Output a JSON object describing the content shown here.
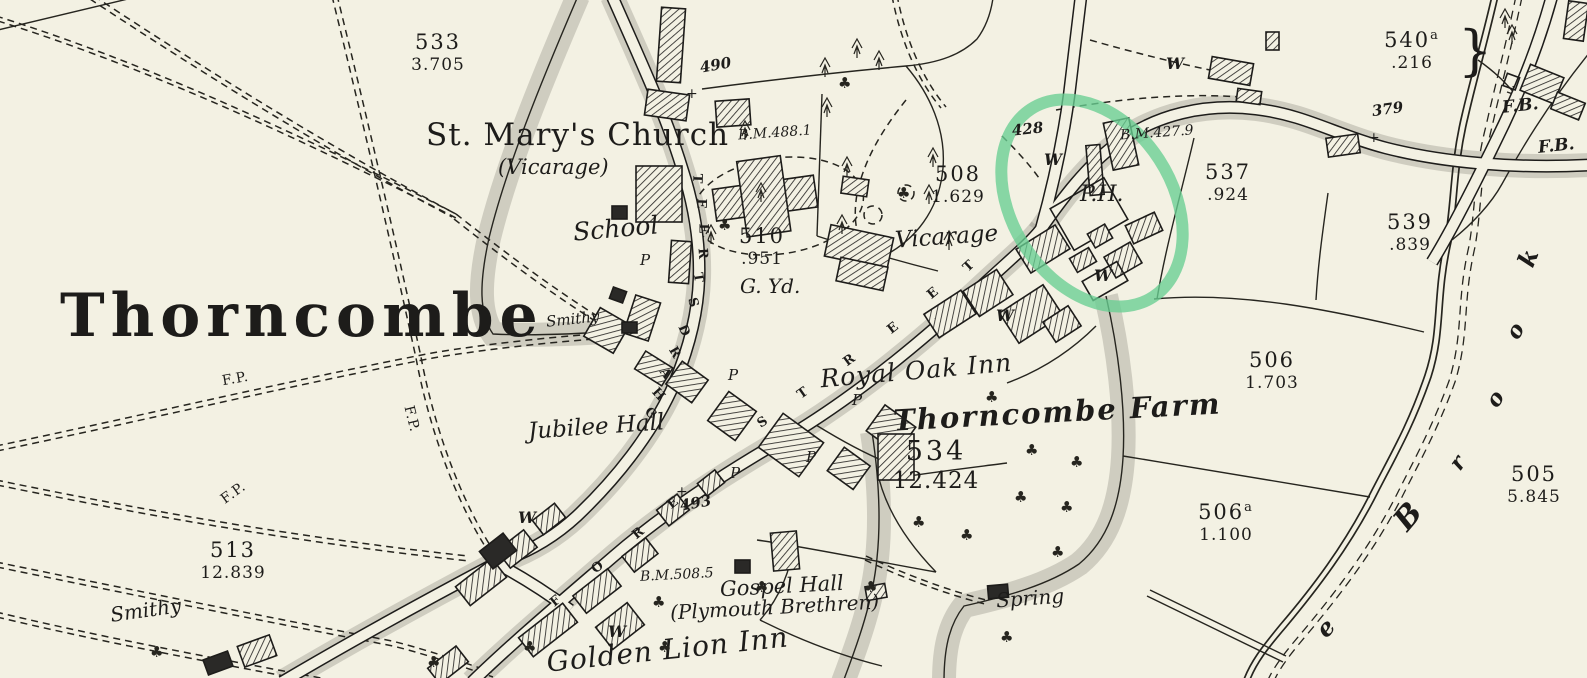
{
  "map_sheet": {
    "paper_color": "#f3f1e3",
    "ink_color": "#1d1c1a",
    "highlight_color": "#68ce92"
  },
  "labels": {
    "village_title": "Thorncombe",
    "church": "St. Mary's Church",
    "church_note": "(Vicarage)",
    "school": "School",
    "vicarage": "Vicarage",
    "graveyard": "G. Yd.",
    "royal_oak_inn": "Royal Oak Inn",
    "thorncombe_farm": "Thorncombe Farm",
    "jubilee_hall": "Jubilee Hall",
    "gospel_hall": "Gospel Hall",
    "gospel_hall_note": "(Plymouth Brethren)",
    "golden_lion_inn": "Golden Lion Inn",
    "smithy": "Smithy",
    "spring": "Spring",
    "public_house": "P.H.",
    "well": "W",
    "pump": "P",
    "footpath": "F.P.",
    "footbridge": "F.B.",
    "cross": "+"
  },
  "parcels": [
    {
      "number": "533",
      "acreage": "3.705"
    },
    {
      "number": "508",
      "acreage": "1.629"
    },
    {
      "number": "510",
      "acreage": ".951"
    },
    {
      "number": "537",
      "acreage": ".924"
    },
    {
      "number": "539",
      "acreage": ".839"
    },
    {
      "number": "506",
      "acreage": "1.703"
    },
    {
      "number": "534",
      "acreage": "12.424"
    },
    {
      "number": "506",
      "suffix": "a",
      "acreage": "1.100"
    },
    {
      "number": "505",
      "acreage": "5.845"
    },
    {
      "number": "540",
      "suffix": "a",
      "acreage": ".216"
    },
    {
      "number": "513",
      "acreage": "12.839"
    }
  ],
  "benchmarks": [
    "B.M.488.1",
    "B.M.427.9",
    "B.M.508.5"
  ],
  "spot_heights": [
    "490",
    "428",
    "379",
    "493"
  ],
  "streets": {
    "chard_street": [
      "T",
      "E",
      "E",
      "R",
      "T",
      "S",
      "D",
      "R",
      "A",
      "H",
      "C"
    ],
    "fore_street": [
      "F",
      "O",
      "R",
      "E"
    ],
    "street_upper": [
      "S",
      "T",
      "R",
      "E",
      "E",
      "T"
    ]
  },
  "brook_letters": [
    "k",
    "o",
    "o",
    "r",
    "B",
    "e"
  ],
  "symbols": {
    "tree": "♣",
    "bracket": "}"
  }
}
